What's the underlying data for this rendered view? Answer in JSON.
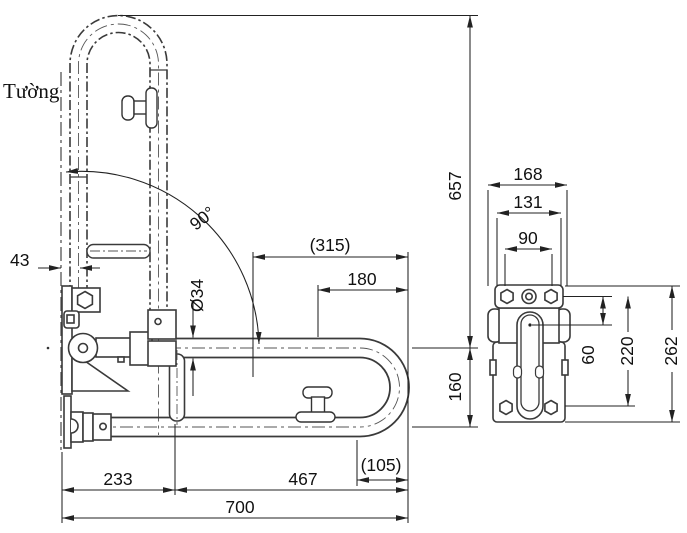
{
  "drawing": {
    "wall_label": "Tường",
    "main_view": {
      "swing_angle": "90°",
      "tube_diameter": "Ø34",
      "wall_offset": "43",
      "overall_height": "657",
      "ref_length_315": "(315)",
      "handle_to_end": "180",
      "run_spacing": "160",
      "bend_ref_105": "(105)",
      "bracket_span": "233",
      "post_to_end": "467",
      "total_length": "700"
    },
    "side_view": {
      "flange_width": "168",
      "outer_bolt_width": "131",
      "inner_width": "90",
      "top_to_pivot": "60",
      "bolt_row_span": "220",
      "plate_height": "262"
    },
    "colors": {
      "outline": "#3a3a3a",
      "dimension": "#222222",
      "centerline": "#555555",
      "background": "#ffffff"
    }
  }
}
